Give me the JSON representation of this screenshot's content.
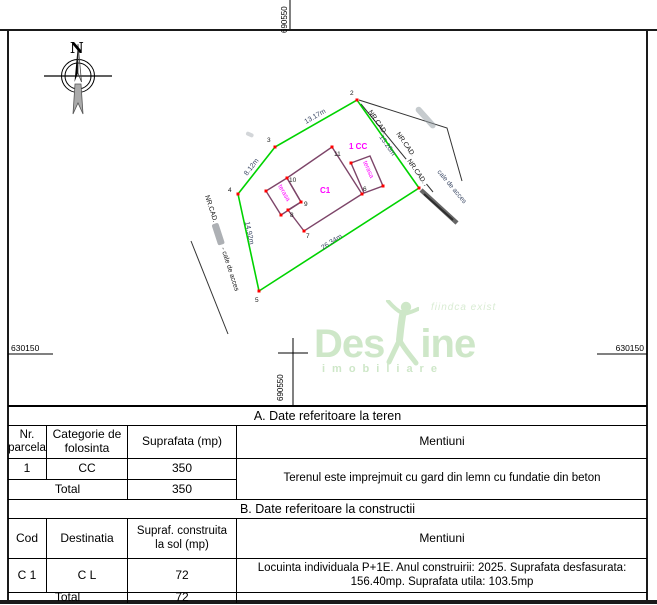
{
  "compass": {
    "north_label": "N"
  },
  "grid": {
    "top": "690550",
    "bottom": "690550",
    "left": "630150",
    "right": "630150"
  },
  "plan": {
    "parcel_use_label": "1 CC",
    "building_label": "C1",
    "terrace_left_label": "terasa",
    "terrace_right_label": "terasa",
    "vertex_labels": {
      "v1": "1",
      "v2": "2",
      "v3": "3",
      "v4": "4",
      "v5": "5",
      "v6": "6",
      "v7": "7",
      "v8": "8",
      "v9": "9",
      "v10": "10",
      "v11": "11"
    },
    "dimensions": {
      "edge_2_3": "13.17m",
      "edge_3_4": "8.12m",
      "edge_4_5": "14.92m",
      "edge_5_1": "26.34m",
      "edge_1_2": "15.26m"
    },
    "cadastral_label_1": "NR.CAD.",
    "cadastral_label_2": "NR.CAD.",
    "cadastral_label_3": "NR.CAD.",
    "cadastral_label_left": "NR.CAD.",
    "access_road_left": "- cale de acces",
    "access_road_right": "cale de acces",
    "colors": {
      "parcel_green": "#00D300",
      "building_purple": "#7D4569",
      "label_magenta": "#FF00FF",
      "vertex_red": "#FF0000",
      "dimension_blue": "#3D4A66"
    }
  },
  "watermark": {
    "word_start": "Des",
    "word_end": "ine",
    "tagline": "fiindca exist",
    "subtitle": "imobiliare",
    "color": "#CEE7C8"
  },
  "table_a": {
    "title": "A. Date referitoare la teren",
    "headers": {
      "col1": "Nr.\nparcela",
      "col2": "Categorie de\nfolosinta",
      "col3": "Suprafata (mp)",
      "col4": "Mentiuni"
    },
    "row": {
      "nr": "1",
      "categorie": "CC",
      "suprafata": "350",
      "mentiuni": "Terenul este imprejmuit cu gard din lemn cu fundatie din beton"
    },
    "total": {
      "label": "Total",
      "suprafata": "350"
    }
  },
  "table_b": {
    "title": "B. Date referitoare la constructii",
    "headers": {
      "col1": "Cod",
      "col2": "Destinatia",
      "col3": "Supraf. construita\nla sol (mp)",
      "col4": "Mentiuni"
    },
    "row": {
      "cod": "C 1",
      "destinatia": "C L",
      "suprafata": "72",
      "mentiuni": "Locuinta individuala P+1E. Anul construirii: 2025. Suprafata desfasurata:\n156.40mp. Suprafata utila: 103.5mp"
    },
    "total": {
      "label": "Total",
      "suprafata": "72"
    }
  }
}
